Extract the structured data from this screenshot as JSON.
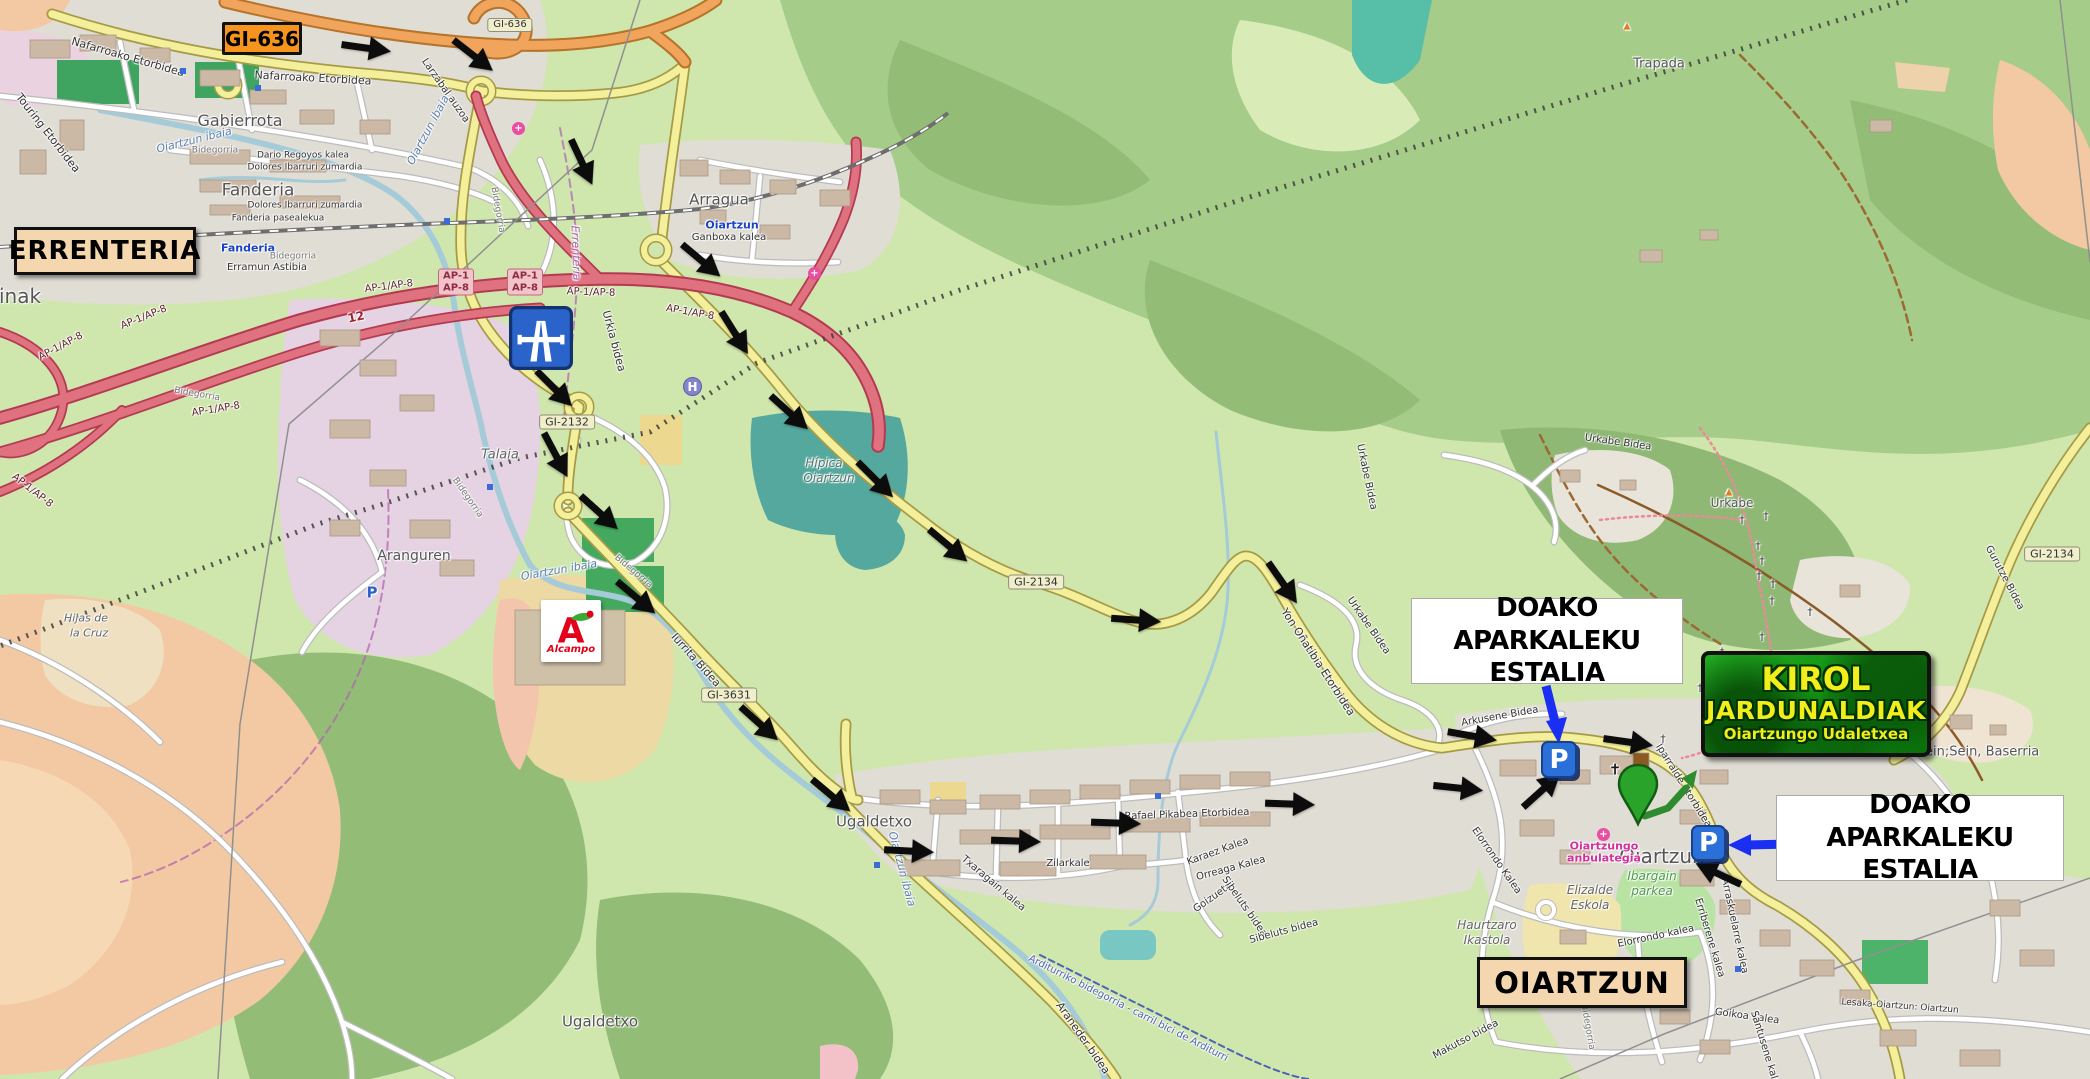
{
  "annotations": {
    "road_badge_gi636": "GI-636",
    "city_left": "ERRENTERIA",
    "city_bottom": "OIARTZUN",
    "free_parking": {
      "line1": "DOAKO APARKALEKU",
      "line2": "ESTALIA"
    },
    "event_badge": {
      "line1": "KIROL",
      "line2": "JARDUNALDIAK",
      "line3": "Oiartzungo Udaletxea"
    },
    "alcampo_logo": {
      "initial": "A",
      "name": "Alcampo"
    },
    "parking_icon_letter": "P",
    "helipad_letter": "H",
    "medical_icon_glyph": "+"
  },
  "colors": {
    "annotation_arrow_blue": "#1b2ff2",
    "route_arrow_black": "#0c0c0c",
    "destination_pin_green": "#2aa32a",
    "event_badge_green": "#129112",
    "event_text_yellow": "#f2ee1b",
    "gi636_badge_orange": "#f7941e",
    "city_box_beige": "#f4d7ae",
    "motorway_sign_blue": "#2a63c9",
    "parking_icon_blue": "#2a70d8",
    "motorway_road_red": "#e0717f",
    "primary_road_orange": "#f0a45c",
    "secondary_road_yellow": "#f3ef9b"
  },
  "map_labels": [
    {
      "t": "Gabierrota",
      "x": 240,
      "y": 121,
      "s": 16,
      "c": "#555"
    },
    {
      "t": "Fanderia",
      "x": 258,
      "y": 191,
      "s": 17,
      "c": "#555"
    },
    {
      "t": "Arragua",
      "x": 719,
      "y": 200,
      "s": 15,
      "c": "#555"
    },
    {
      "t": "Talaia",
      "x": 500,
      "y": 455,
      "s": 13,
      "c": "#666",
      "i": 1
    },
    {
      "t": "Aranguren",
      "x": 414,
      "y": 556,
      "s": 14,
      "c": "#555"
    },
    {
      "t": "Ugaldetxo",
      "x": 874,
      "y": 822,
      "s": 15,
      "c": "#555"
    },
    {
      "t": "Ugaldetxo",
      "x": 600,
      "y": 1022,
      "s": 15,
      "c": "#555"
    },
    {
      "t": "Trapada",
      "x": 1659,
      "y": 64,
      "s": 13,
      "c": "#555"
    },
    {
      "t": "Urkabe",
      "x": 1732,
      "y": 503,
      "s": 12,
      "c": "#555"
    },
    {
      "t": "Oiartzun",
      "x": 1662,
      "y": 856,
      "s": 20,
      "c": "#555"
    },
    {
      "t": "Hijas de",
      "x": 86,
      "y": 618,
      "s": 11,
      "c": "#666",
      "i": 1
    },
    {
      "t": "la Cruz",
      "x": 89,
      "y": 633,
      "s": 11,
      "c": "#666",
      "i": 1
    },
    {
      "t": "inak",
      "x": 20,
      "y": 296,
      "s": 20,
      "c": "#555"
    },
    {
      "t": "Sein;Sein, Baserria",
      "x": 1978,
      "y": 752,
      "s": 13,
      "c": "#555"
    },
    {
      "t": "Hípica",
      "x": 824,
      "y": 463,
      "s": 12,
      "c": "#54766b",
      "i": 1
    },
    {
      "t": "Oiartzun",
      "x": 829,
      "y": 478,
      "s": 12,
      "c": "#54766b",
      "i": 1
    },
    {
      "t": "Ibargain",
      "x": 1652,
      "y": 876,
      "s": 12,
      "c": "#4e9a4e",
      "i": 1
    },
    {
      "t": "parkea",
      "x": 1652,
      "y": 891,
      "s": 12,
      "c": "#4e9a4e",
      "i": 1
    },
    {
      "t": "Elizalde",
      "x": 1590,
      "y": 890,
      "s": 12,
      "c": "#666",
      "i": 1
    },
    {
      "t": "Eskola",
      "x": 1590,
      "y": 905,
      "s": 12,
      "c": "#666",
      "i": 1
    },
    {
      "t": "Haurtzaro",
      "x": 1487,
      "y": 925,
      "s": 12,
      "c": "#666",
      "i": 1
    },
    {
      "t": "Ikastola",
      "x": 1487,
      "y": 940,
      "s": 12,
      "c": "#666",
      "i": 1
    },
    {
      "t": "Oiartzungo",
      "x": 1604,
      "y": 846,
      "s": 11,
      "c": "#d12f9e",
      "b": 1
    },
    {
      "t": "anbulategia",
      "x": 1604,
      "y": 858,
      "s": 11,
      "c": "#d12f9e",
      "b": 1
    },
    {
      "t": "Fanderia",
      "x": 248,
      "y": 248,
      "s": 11,
      "c": "#1a43c4",
      "b": 1
    },
    {
      "t": "Oiartzun",
      "x": 732,
      "y": 225,
      "s": 11,
      "c": "#1a43c4",
      "b": 1
    },
    {
      "t": "Errenteria",
      "x": 576,
      "y": 253,
      "s": 11,
      "c": "#a85fa8",
      "i": 1,
      "r": 88
    },
    {
      "t": "▲",
      "x": 1729,
      "y": 493,
      "s": 9,
      "c": "#e07b28"
    },
    {
      "t": "▲",
      "x": 1627,
      "y": 27,
      "s": 9,
      "c": "#e07b28"
    },
    {
      "t": "Nafarroako Etorbidea",
      "x": 128,
      "y": 57,
      "s": 11,
      "r": 16
    },
    {
      "t": "Nafarroako Etorbidea",
      "x": 313,
      "y": 78,
      "s": 11,
      "r": 3
    },
    {
      "t": "Touring Etorbidea",
      "x": 48,
      "y": 133,
      "s": 11,
      "r": 52
    },
    {
      "t": "Dario Regoyos kalea",
      "x": 303,
      "y": 156,
      "s": 9
    },
    {
      "t": "Dolores Ibarruri zumardia",
      "x": 305,
      "y": 168,
      "s": 9
    },
    {
      "t": "Dolores Ibarruri zumardia",
      "x": 305,
      "y": 206,
      "s": 9
    },
    {
      "t": "Fanderia pasealekua",
      "x": 278,
      "y": 219,
      "s": 9
    },
    {
      "t": "Erramun Astibia",
      "x": 267,
      "y": 268,
      "s": 10
    },
    {
      "t": "Larzabal auzoa",
      "x": 445,
      "y": 91,
      "s": 10,
      "r": 55
    },
    {
      "t": "Ganboxa kalea",
      "x": 729,
      "y": 238,
      "s": 10
    },
    {
      "t": "Urkia bidea",
      "x": 614,
      "y": 341,
      "s": 11,
      "r": 75
    },
    {
      "t": "Iurrita Bidea",
      "x": 696,
      "y": 660,
      "s": 11,
      "r": 48
    },
    {
      "t": "Yon Oñatibia Etorbidea",
      "x": 1318,
      "y": 662,
      "s": 11,
      "r": 57
    },
    {
      "t": "Rafael Pikabea Etorbidea",
      "x": 1187,
      "y": 815,
      "s": 10,
      "r": -2
    },
    {
      "t": "Zilarkale",
      "x": 1068,
      "y": 864,
      "s": 10
    },
    {
      "t": "Txaragain kalea",
      "x": 993,
      "y": 884,
      "s": 10,
      "r": 40
    },
    {
      "t": "Karaez Kalea",
      "x": 1218,
      "y": 852,
      "s": 10,
      "r": -20
    },
    {
      "t": "Orreaga Kalea",
      "x": 1231,
      "y": 869,
      "s": 10,
      "r": -15
    },
    {
      "t": "Goizueta",
      "x": 1213,
      "y": 898,
      "s": 10,
      "r": -35
    },
    {
      "t": "Sibeluts bidea",
      "x": 1244,
      "y": 907,
      "s": 10,
      "r": 55
    },
    {
      "t": "Sibeluts bidea",
      "x": 1284,
      "y": 932,
      "s": 10,
      "r": -15
    },
    {
      "t": "Araneder bidea",
      "x": 1083,
      "y": 1038,
      "s": 11,
      "r": 55
    },
    {
      "t": "Arkusene Bidea",
      "x": 1500,
      "y": 717,
      "s": 10,
      "r": -10
    },
    {
      "t": "Iparralde Etorbidea",
      "x": 1683,
      "y": 786,
      "s": 10,
      "r": 58
    },
    {
      "t": "Elorrondo Kalea",
      "x": 1496,
      "y": 861,
      "s": 10,
      "r": 55
    },
    {
      "t": "Elorrondo kalea",
      "x": 1656,
      "y": 937,
      "s": 10,
      "r": -12
    },
    {
      "t": "Erriberene kalea",
      "x": 1709,
      "y": 938,
      "s": 10,
      "r": 73
    },
    {
      "t": "Arraskuelarre kalea",
      "x": 1734,
      "y": 926,
      "s": 10,
      "r": 78
    },
    {
      "t": "Goikoa Kalea",
      "x": 1747,
      "y": 1017,
      "s": 10,
      "r": 8
    },
    {
      "t": "Santusene kalea",
      "x": 1765,
      "y": 1051,
      "s": 10,
      "r": 73
    },
    {
      "t": "Makutso bidea",
      "x": 1466,
      "y": 1040,
      "s": 10,
      "r": -28
    },
    {
      "t": "Urkabe Bidea",
      "x": 1618,
      "y": 443,
      "s": 10,
      "r": 8
    },
    {
      "t": "Urkabe Bidea",
      "x": 1366,
      "y": 477,
      "s": 10,
      "r": 78
    },
    {
      "t": "Urkabe Bidea",
      "x": 1368,
      "y": 626,
      "s": 10,
      "r": 55
    },
    {
      "t": "Gurutze Bidea",
      "x": 2004,
      "y": 578,
      "s": 10,
      "r": 62
    },
    {
      "t": "Lesaka-Oiartzun: Oiartzun",
      "x": 1900,
      "y": 1007,
      "s": 9,
      "r": 4
    },
    {
      "t": "Bidegorria",
      "x": 215,
      "y": 151,
      "s": 9,
      "c": "#777"
    },
    {
      "t": "Bidegorria",
      "x": 67,
      "y": 256,
      "s": 9,
      "c": "#777"
    },
    {
      "t": "Bidegorria",
      "x": 293,
      "y": 257,
      "s": 9,
      "c": "#777"
    },
    {
      "t": "Bidegorria",
      "x": 497,
      "y": 210,
      "s": 9,
      "c": "#777",
      "r": 80
    },
    {
      "t": "Bidegorria",
      "x": 197,
      "y": 395,
      "s": 9,
      "c": "#777",
      "r": 10
    },
    {
      "t": "Bidegorria",
      "x": 467,
      "y": 498,
      "s": 9,
      "c": "#777",
      "r": 55
    },
    {
      "t": "Bidegorria",
      "x": 633,
      "y": 572,
      "s": 9,
      "c": "#777",
      "r": 40
    },
    {
      "t": "Bidegorria",
      "x": 1587,
      "y": 1027,
      "s": 9,
      "c": "#777",
      "r": 80
    },
    {
      "t": "Arditurriko bidegorria - carril bici de Arditurri",
      "x": 1128,
      "y": 1009,
      "s": 10,
      "c": "#4f63b5",
      "r": 27
    },
    {
      "t": "Oiartzun ibaia",
      "x": 194,
      "y": 140,
      "s": 11,
      "c": "#5a7fae",
      "i": 1,
      "r": -14
    },
    {
      "t": "Oiartzun ibaia",
      "x": 428,
      "y": 130,
      "s": 11,
      "c": "#5a7fae",
      "i": 1,
      "r": -62
    },
    {
      "t": "Oiartzun ibaia",
      "x": 559,
      "y": 570,
      "s": 11,
      "c": "#5a7fae",
      "i": 1,
      "r": -10
    },
    {
      "t": "Oiartzun ibaia",
      "x": 902,
      "y": 869,
      "s": 11,
      "c": "#5a7fae",
      "i": 1,
      "r": 75
    },
    {
      "t": "AP-1/AP-8",
      "x": 389,
      "y": 287,
      "s": 10,
      "c": "#5e1f28",
      "r": -7
    },
    {
      "t": "AP-1/AP-8",
      "x": 591,
      "y": 293,
      "s": 10,
      "c": "#5e1f28",
      "r": 2
    },
    {
      "t": "AP-1/AP-8",
      "x": 690,
      "y": 313,
      "s": 10,
      "c": "#5e1f28",
      "r": 10
    },
    {
      "t": "AP-1/AP-8",
      "x": 144,
      "y": 318,
      "s": 10,
      "c": "#5e1f28",
      "r": -22
    },
    {
      "t": "AP-1/AP-8",
      "x": 61,
      "y": 347,
      "s": 10,
      "c": "#5e1f28",
      "r": -28
    },
    {
      "t": "AP-1/AP-8",
      "x": 32,
      "y": 491,
      "s": 10,
      "c": "#5e1f28",
      "r": 38
    },
    {
      "t": "AP-1/AP-8",
      "x": 216,
      "y": 410,
      "s": 10,
      "c": "#5e1f28",
      "r": -9
    },
    {
      "t": "12",
      "x": 356,
      "y": 317,
      "s": 12,
      "c": "#a02030",
      "b": 1,
      "r": -12
    },
    {
      "t": "GI-2132",
      "x": 567,
      "y": 422,
      "s": 11,
      "st": "shield"
    },
    {
      "t": "GI-2134",
      "x": 1036,
      "y": 582,
      "s": 11,
      "st": "shield"
    },
    {
      "t": "GI-2134",
      "x": 2052,
      "y": 554,
      "s": 11,
      "st": "shield"
    },
    {
      "t": "GI-3631",
      "x": 729,
      "y": 695,
      "s": 11,
      "st": "shield"
    },
    {
      "t": "GI-636",
      "x": 510,
      "y": 25,
      "s": 10,
      "st": "shield"
    },
    {
      "t": "AP-1\nAP-8",
      "x": 456,
      "y": 282,
      "s": 10,
      "st": "pink"
    },
    {
      "t": "AP-1\nAP-8",
      "x": 525,
      "y": 282,
      "s": 10,
      "st": "pink"
    },
    {
      "t": "✝",
      "x": 1615,
      "y": 770,
      "s": 15,
      "c": "#1a1a1a",
      "b": 1
    },
    {
      "t": "†",
      "x": 1742,
      "y": 520,
      "s": 11,
      "c": "#333"
    },
    {
      "t": "†",
      "x": 1766,
      "y": 516,
      "s": 11,
      "c": "#333"
    },
    {
      "t": "†",
      "x": 1758,
      "y": 546,
      "s": 11,
      "c": "#333"
    },
    {
      "t": "†",
      "x": 1762,
      "y": 561,
      "s": 11,
      "c": "#333"
    },
    {
      "t": "†",
      "x": 1759,
      "y": 576,
      "s": 11,
      "c": "#333"
    },
    {
      "t": "†",
      "x": 1773,
      "y": 584,
      "s": 11,
      "c": "#333"
    },
    {
      "t": "†",
      "x": 1772,
      "y": 601,
      "s": 11,
      "c": "#333"
    },
    {
      "t": "†",
      "x": 1810,
      "y": 612,
      "s": 11,
      "c": "#333"
    },
    {
      "t": "†",
      "x": 1762,
      "y": 637,
      "s": 11,
      "c": "#333"
    },
    {
      "t": "†",
      "x": 1722,
      "y": 652,
      "s": 11,
      "c": "#333"
    },
    {
      "t": "†",
      "x": 1700,
      "y": 688,
      "s": 11,
      "c": "#333"
    },
    {
      "t": "†",
      "x": 1663,
      "y": 739,
      "s": 11,
      "c": "#333"
    },
    {
      "t": "P",
      "x": 372,
      "y": 593,
      "s": 15,
      "c": "#2a62c8",
      "b": 1
    }
  ],
  "route_arrows": [
    [
      366,
      50,
      8
    ],
    [
      472,
      57,
      38
    ],
    [
      580,
      163,
      65
    ],
    [
      700,
      262,
      40
    ],
    [
      733,
      334,
      58
    ],
    [
      788,
      414,
      42
    ],
    [
      874,
      481,
      45
    ],
    [
      947,
      547,
      40
    ],
    [
      1136,
      622,
      4
    ],
    [
      1281,
      584,
      55
    ],
    [
      553,
      390,
      45
    ],
    [
      554,
      456,
      62
    ],
    [
      598,
      514,
      42
    ],
    [
      635,
      599,
      40
    ],
    [
      758,
      725,
      42
    ],
    [
      830,
      797,
      40
    ],
    [
      909,
      853,
      3
    ],
    [
      1016,
      843,
      2
    ],
    [
      1116,
      825,
      2
    ],
    [
      1290,
      806,
      2
    ],
    [
      1458,
      790,
      6
    ],
    [
      1472,
      738,
      10
    ],
    [
      1543,
      792,
      -42
    ],
    [
      1628,
      744,
      8
    ],
    [
      1719,
      872,
      205
    ]
  ],
  "map_dots": [
    [
      183,
      71
    ],
    [
      258,
      88
    ],
    [
      447,
      221
    ],
    [
      490,
      487
    ],
    [
      877,
      865
    ],
    [
      1738,
      969
    ],
    [
      1158,
      796
    ]
  ]
}
